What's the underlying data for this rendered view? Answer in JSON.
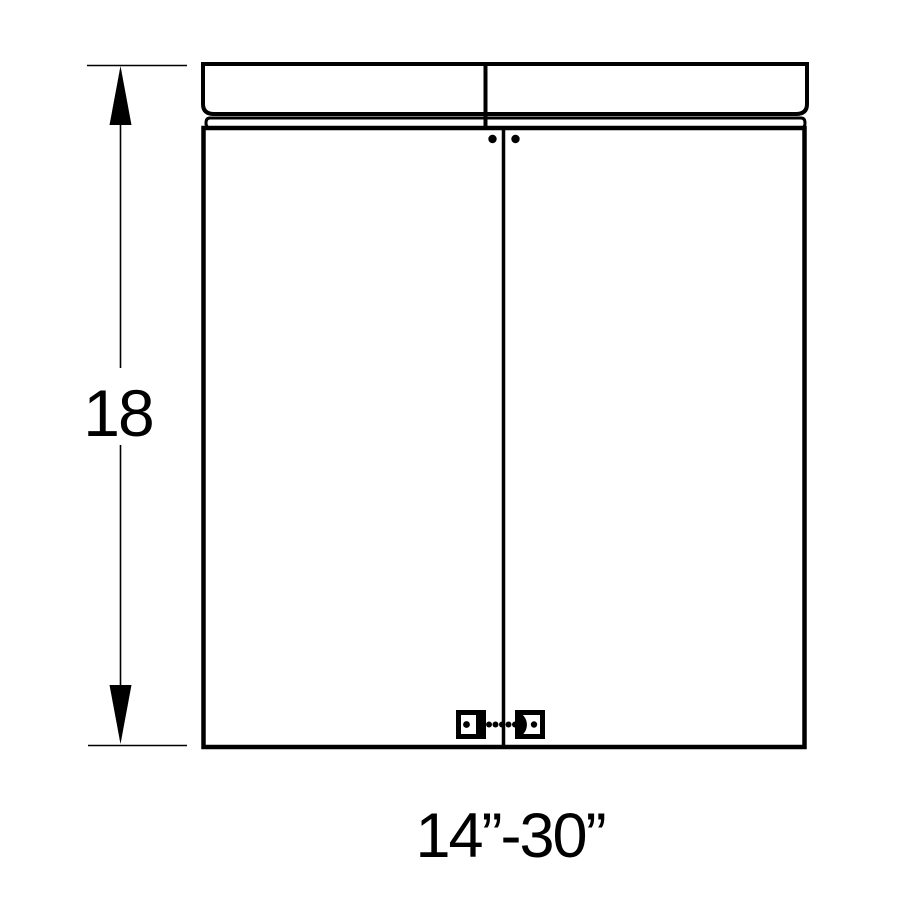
{
  "diagram": {
    "type": "cabinet-dimension-drawing",
    "height_label": "18",
    "width_label": "14”-30”",
    "colors": {
      "line": "#000000",
      "background": "#ffffff"
    }
  }
}
